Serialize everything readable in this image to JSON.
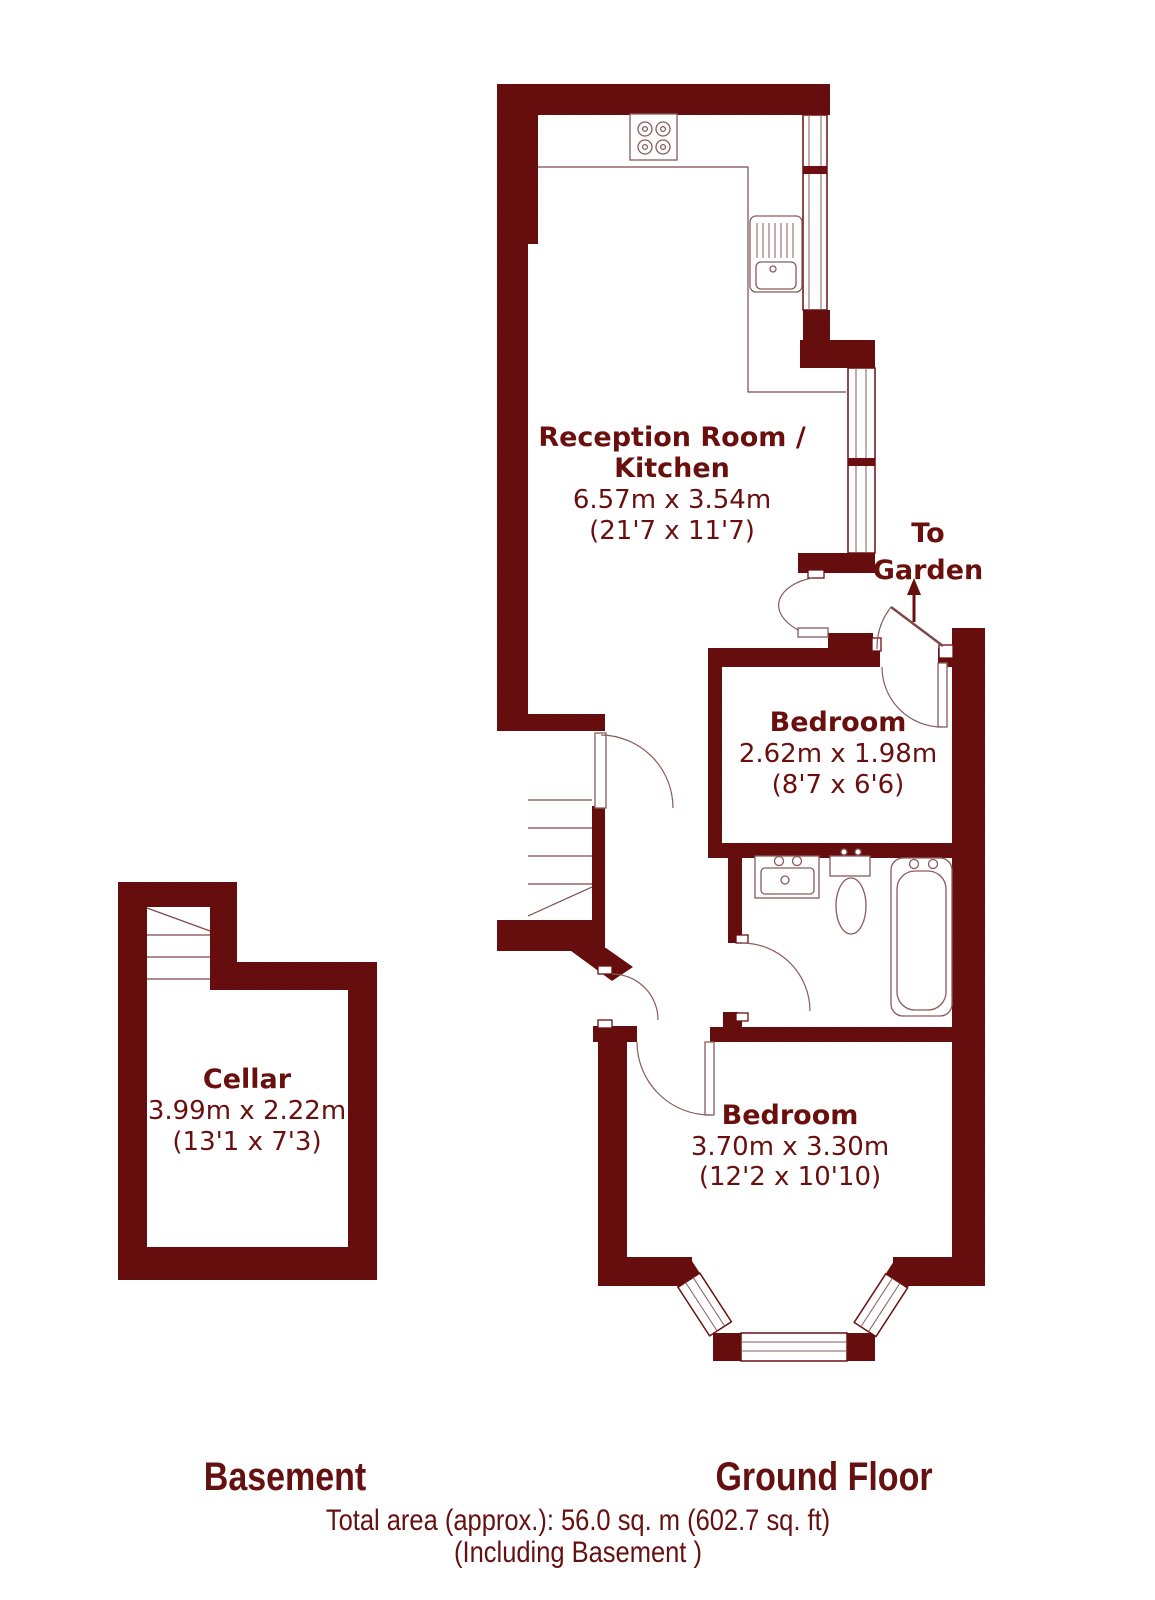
{
  "document": {
    "type": "floor-plan"
  },
  "colors": {
    "wall": "#6d0f10",
    "wall_shade": "#5e0b0c",
    "ink": "#69100f",
    "outline": "#8a5b5b",
    "background": "#ffffff"
  },
  "rooms": {
    "reception_kitchen": {
      "title_line1": "Reception Room /",
      "title_line2": "Kitchen",
      "dims_metric": "6.57m x 3.54m",
      "dims_imperial": "(21'7 x 11'7)"
    },
    "bedroom_small": {
      "title": "Bedroom",
      "dims_metric": "2.62m x 1.98m",
      "dims_imperial": "(8'7 x 6'6)"
    },
    "bedroom_large": {
      "title": "Bedroom",
      "dims_metric": "3.70m x 3.30m",
      "dims_imperial": "(12'2 x 10'10)"
    },
    "cellar": {
      "title": "Cellar",
      "dims_metric": "3.99m x 2.22m",
      "dims_imperial": "(13'1 x 7'3)"
    }
  },
  "annotations": {
    "to_garden_line1": "To",
    "to_garden_line2": "Garden"
  },
  "floor_labels": {
    "basement": "Basement",
    "ground_floor": "Ground Floor"
  },
  "footer": {
    "total_area": "Total area (approx.): 56.0 sq. m (602.7 sq. ft)",
    "including": "(Including Basement )"
  },
  "fixtures": {
    "kitchen": [
      "hob-icon",
      "sink-drainer-icon"
    ],
    "bathroom": [
      "basin-icon",
      "toilet-icon",
      "bathtub-icon"
    ],
    "circulation": [
      "stairs-ground",
      "stairs-basement",
      "entrance-door",
      "garden-door",
      "bay-window"
    ]
  }
}
